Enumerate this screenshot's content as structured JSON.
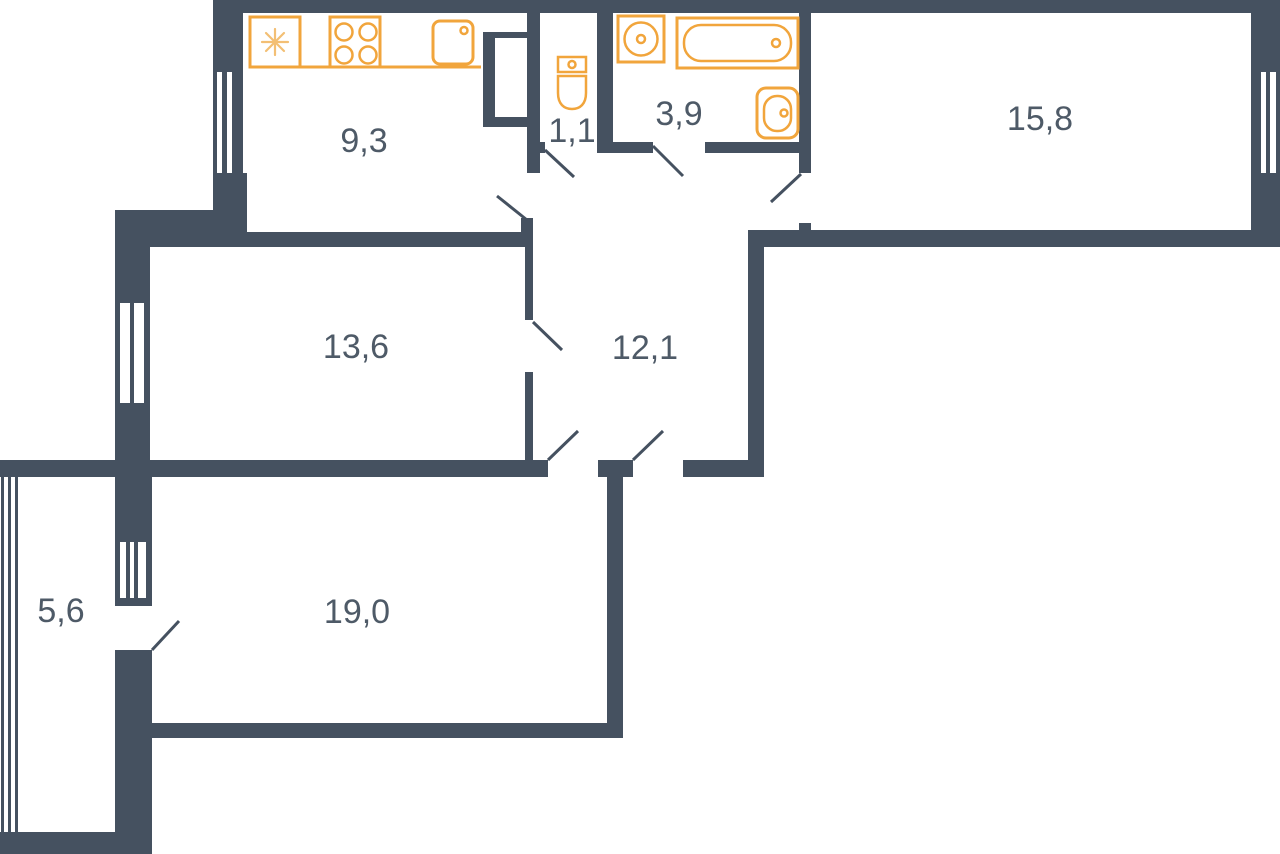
{
  "rooms": [
    {
      "name": "kitchen",
      "area": "9,3"
    },
    {
      "name": "wc",
      "area": "1,1"
    },
    {
      "name": "bathroom",
      "area": "3,9"
    },
    {
      "name": "room-top-right",
      "area": "15,8"
    },
    {
      "name": "room-middle-left",
      "area": "13,6"
    },
    {
      "name": "hallway",
      "area": "12,1"
    },
    {
      "name": "room-bottom",
      "area": "19,0"
    },
    {
      "name": "balcony",
      "area": "5,6"
    }
  ],
  "fixtures": [
    "fridge",
    "stove",
    "kitchen-sink",
    "toilet",
    "round-washbasin",
    "bathtub",
    "washbasin"
  ],
  "colors": {
    "wall": "#455160",
    "label": "#4e5a67",
    "fixture": "#f1a53c",
    "fixture_light": "#f3bf74",
    "background": "#ffffff"
  }
}
